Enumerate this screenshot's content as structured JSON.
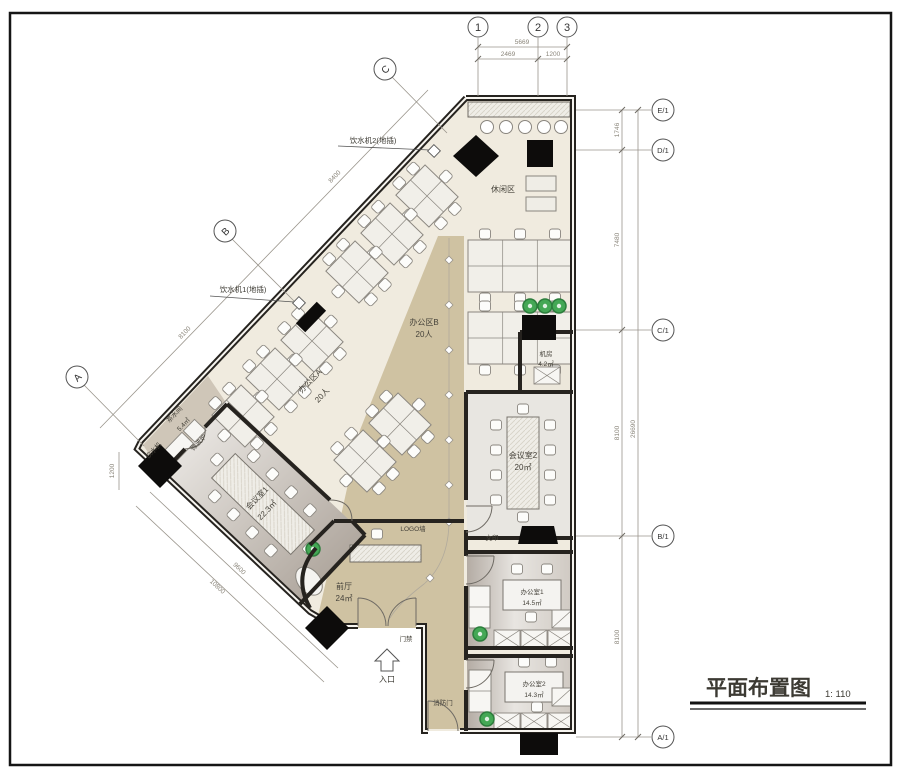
{
  "title": {
    "text": "平面布置图",
    "scale": "1: 110"
  },
  "grid_bubbles": {
    "top": [
      "1",
      "2",
      "3"
    ],
    "right": [
      "E/1",
      "D/1",
      "C/1",
      "B/1",
      "A/1"
    ],
    "left": [
      "C",
      "B",
      "A"
    ]
  },
  "dims": {
    "top_total": "5669",
    "top_seg1": "2469",
    "top_seg2": "1200",
    "right_total": "26690",
    "right_seg1": "1746",
    "right_seg2": "7480",
    "right_seg3": "8100",
    "right_seg4": "8100",
    "diag_seg1": "8400",
    "diag_seg2": "8100",
    "bottom_outer": "10800",
    "bottom_inner": "9600",
    "left_small": "1200"
  },
  "rooms": {
    "leisure": {
      "name": "休闲区"
    },
    "office_b": {
      "name": "办公区B",
      "capacity": "20人"
    },
    "office_a": {
      "name": "办公区A",
      "capacity": "20人"
    },
    "machine": {
      "name": "机房",
      "area": "4.2㎡"
    },
    "meeting2": {
      "name": "会议室2",
      "area": "20㎡"
    },
    "meeting1": {
      "name": "会议室1",
      "area": "22.3㎡"
    },
    "tea": {
      "name": "茶水间",
      "area": "5.4㎡"
    },
    "lobby": {
      "name": "前厅",
      "area": "24㎡"
    },
    "office1": {
      "name": "办公室1",
      "area": "14.5㎡"
    },
    "office2": {
      "name": "办公室2",
      "area": "14.3㎡"
    }
  },
  "labels": {
    "logo_wall": "LOGO墙",
    "print": "文印",
    "access": "门禁",
    "entrance": "入口",
    "fire_door": "消防门",
    "microwave": "微波炉",
    "water_dispenser": "饮水机",
    "note_water1": "饮水机1(地插)",
    "note_water2": "饮水机2(地插)"
  },
  "colors": {
    "floor": "#f0ebdf",
    "walkway": "#cfc2a2",
    "meeting_gray": "#e8e6e1",
    "wall": "#26231f",
    "plant_green": "#44a855"
  }
}
